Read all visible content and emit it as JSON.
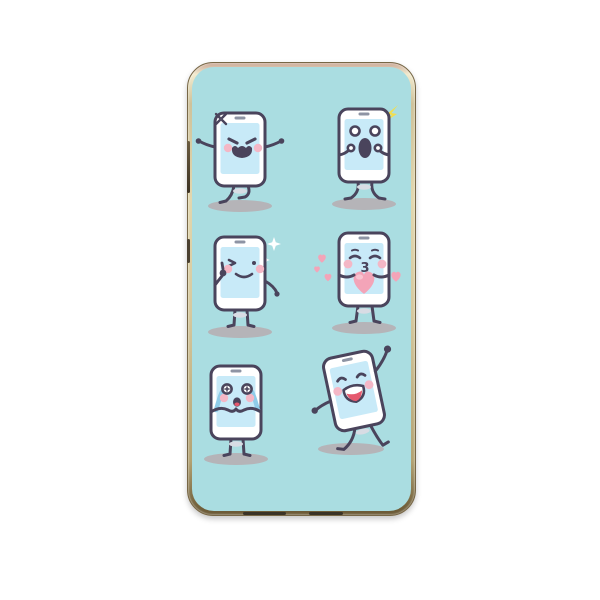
{
  "page": {
    "background_color": "#ffffff"
  },
  "product": {
    "kind": "phone-case-with-cartoon-smartphone-print",
    "print_background": "#aadde1",
    "frame_color_light": "#f2ebcf",
    "frame_color_mid": "#d6c99e",
    "frame_color_dark": "#6d5c38",
    "side_buttons": 2,
    "bottom_ports": 2
  },
  "colors": {
    "page_bg": "#ffffff",
    "print_bg": "#aadde1",
    "outline": "#4a445c",
    "body": "#ffffff",
    "screen": "#c8eaf8",
    "cheek": "#f4b7c6",
    "ground_shadow": "#b5b4b8",
    "tear": "#8fcce9",
    "heart": "#f3a4b8",
    "heart_light": "#f8c3d0",
    "tongue": "#e5596e",
    "flash": "#f2de4e",
    "sparkle": "#ffffff",
    "speaker": "#8e94a4",
    "home_button": "#d8dce4"
  },
  "characters": [
    {
      "id": "angry",
      "emotion": "angry",
      "extras": [
        "anger-mark"
      ],
      "pose": "arms-out-walking"
    },
    {
      "id": "surprised",
      "emotion": "shocked",
      "extras": [
        "yellow-flash"
      ],
      "pose": "hands-to-face-knock-knees"
    },
    {
      "id": "wink",
      "emotion": "winking-smile",
      "extras": [
        "white-sparkles"
      ],
      "pose": "thumbs-up"
    },
    {
      "id": "kiss",
      "emotion": "blowing-kiss",
      "extras": [
        "floating-hearts",
        "big-heart"
      ],
      "pose": "holding-heart",
      "mouth_glyph": "3"
    },
    {
      "id": "crying",
      "emotion": "crying",
      "extras": [
        "blue-tears"
      ],
      "pose": "hands-under-mouth"
    },
    {
      "id": "dancing",
      "emotion": "laughing",
      "extras": [
        "raised-fist"
      ],
      "pose": "tilted-dancing"
    }
  ]
}
